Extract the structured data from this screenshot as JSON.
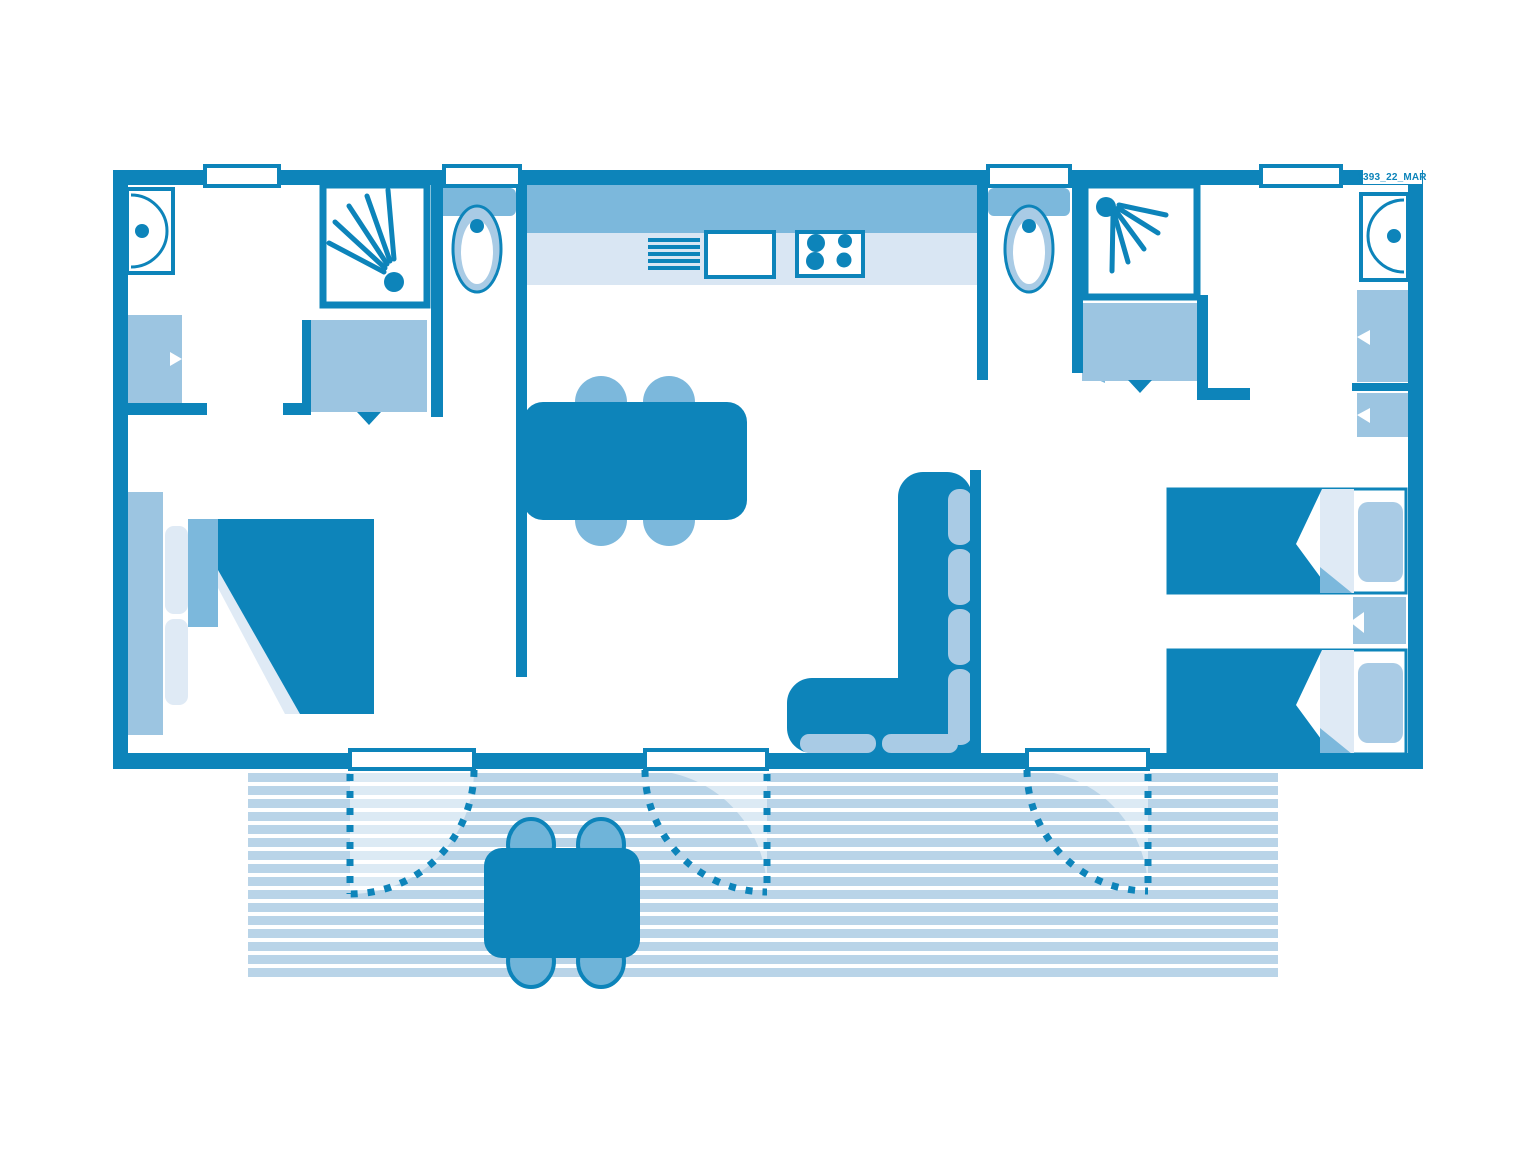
{
  "plan": {
    "reference_label": "1393_22_MAR",
    "colors": {
      "dark": "#0d84ba",
      "medium": "#7cb8dc",
      "wardrobe": "#9cc5e1",
      "cushion": "#a9cbe5",
      "counter": "#d9e6f3",
      "stripe": "#b9d4e8",
      "verylight": "#dfeaf5",
      "chair": "#6fb4d9"
    },
    "rooms": [
      "master-bedroom",
      "bathroom-left",
      "wc-left",
      "kitchen",
      "living-dining",
      "wc-right",
      "bathroom-right",
      "twin-bedroom",
      "terrace"
    ],
    "furniture_icons": [
      "washbasin-icon",
      "shower-icon",
      "toilet-icon",
      "wardrobe-icon",
      "kitchen-counter-icon",
      "sink-icon",
      "stove-icon",
      "dining-table-icon",
      "chair-icon",
      "corner-sofa-icon",
      "double-bed-icon",
      "single-bed-icon",
      "nightstand-icon",
      "terrace-table-icon",
      "door-swing-icon",
      "window-icon"
    ]
  }
}
